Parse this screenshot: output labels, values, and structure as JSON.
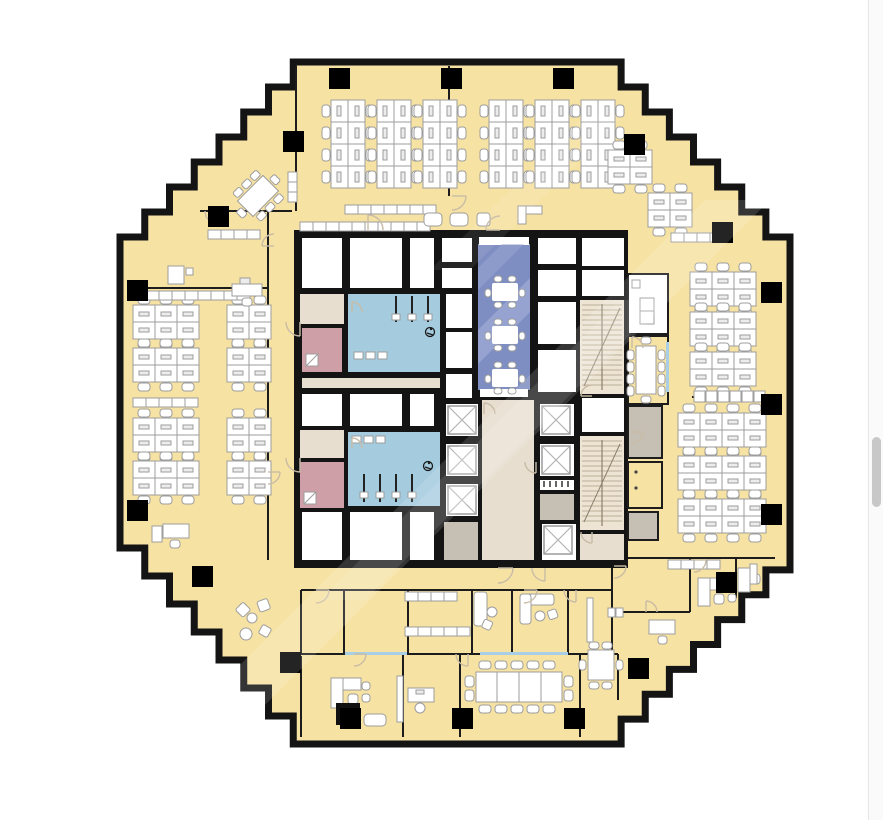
{
  "app": {
    "type": "floor-plan-viewer",
    "visible_text": "none"
  },
  "palette": {
    "office": "#f6e2a3",
    "wall": "#141414",
    "thinWall": "#1c1c1c",
    "column": "#000000",
    "room": "#ffffff",
    "restroom": "#a4cbde",
    "conference": "#7f8ec2",
    "conferenceStripe": "#9aa7d2",
    "pink": "#cf9fa8",
    "corridor": "#e8ded0",
    "utility": "#c6c0b4",
    "stair": "#ede4d4",
    "stairTread": "#bcae94",
    "furniture": "#9d9d9d",
    "furnitureFill": "#ffffff",
    "door": "#c9bca6",
    "glass": "#a9cfe6",
    "shaftX": "#b4b4b4",
    "blackCab": "#111111",
    "watermark": "#ffffff",
    "scrollTrack": "#fafafa",
    "scrollThumb": "#c8c8c8"
  },
  "floor_plan": {
    "shape": "octagon-sawtooth",
    "zones": [
      {
        "name": "open-office-north",
        "desk_clusters": 6,
        "desks_per_cluster": 8
      },
      {
        "name": "open-office-west",
        "desk_clusters": 8
      },
      {
        "name": "open-office-east",
        "desk_clusters": 7
      },
      {
        "name": "open-office-northeast",
        "desk_clusters": 2
      },
      {
        "name": "core-conference-room",
        "tables": 3
      },
      {
        "name": "restroom-north",
        "accessible": true
      },
      {
        "name": "restroom-south",
        "accessible": true
      },
      {
        "name": "elevator-shafts",
        "count": 6
      },
      {
        "name": "stairwells",
        "count": 2
      },
      {
        "name": "boardroom-south",
        "seats": 14
      },
      {
        "name": "meeting-room-east",
        "seats": 10
      },
      {
        "name": "private-offices-south"
      },
      {
        "name": "lounge-areas"
      }
    ],
    "perimeter_columns": 19
  },
  "scrollbar": {
    "track_width_px": 15,
    "thumb_top_px": 437,
    "thumb_height_px": 70
  }
}
